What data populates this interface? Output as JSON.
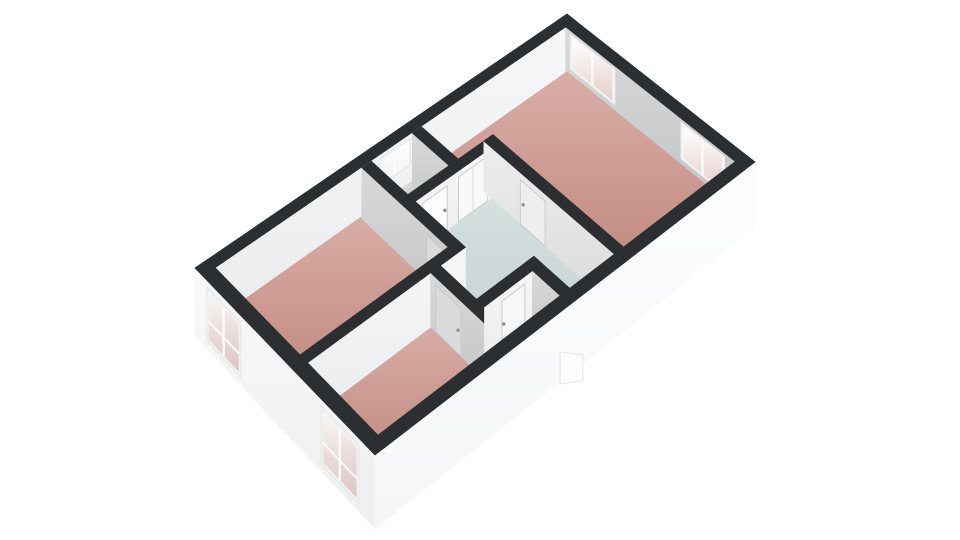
{
  "page": {
    "background": "#ffffff"
  },
  "floorplan": {
    "band_color": "#2c2f31",
    "outline_soft": "#e2e3e4",
    "handle_color": "#8d8f91",
    "door_outline": "#c6c8ca",
    "projection": {
      "corners": {
        "w": [
          195,
          268
        ],
        "n": [
          567,
          14
        ],
        "e": [
          755,
          162
        ],
        "s": [
          375,
          455
        ]
      },
      "plan_size": [
        10,
        6
      ],
      "drop_base": 46,
      "drop_per_y": 0.03,
      "slab_extra": 14
    },
    "gradients": {
      "whiteFace": [
        "#f6f7f8",
        "#eaecee"
      ],
      "grayFace": [
        "#d7d9db",
        "#c2c4c6"
      ],
      "lightFace": [
        "#ebedee",
        "#d9dbdd"
      ],
      "facadeSW": [
        "#f8f9fa",
        "#edeff0"
      ],
      "facadeSE": [
        "#fdfdfe",
        "#f5f6f7"
      ],
      "pinkFloor": [
        "#d8aea6",
        "#bd8279"
      ],
      "toiletFloor": [
        "#d7d9da",
        "#c8cacc"
      ],
      "hallFloor": [
        "#d5e0df",
        "#c3d2d1"
      ],
      "closetFloor": [
        "#e5e7e8",
        "#d8dadb"
      ],
      "glazePink": [
        "#ffffff",
        "#e5cfca"
      ],
      "glazeWhite": [
        "#ffffff",
        "#f1f1f2"
      ],
      "glazeFacade": [
        "#f8f6f6",
        "#ddc4bf"
      ]
    },
    "layers": [
      {
        "t": "top",
        "name": "wall-top-nw",
        "r": [
          0,
          0,
          10,
          0.3
        ]
      },
      {
        "t": "face",
        "name": "wall-nw-interior",
        "a": [
          0.3,
          0.3
        ],
        "b": [
          9.7,
          0.3
        ],
        "g": "whiteFace",
        "feats": [
          {
            "t": "window",
            "name": "window-toilet",
            "a": [
              4.45,
              0.3
            ],
            "b": [
              5.3,
              0.3
            ],
            "f1": 0.08,
            "f2": 0.6,
            "frame": "#f2f3f4",
            "glaze": "glazeWhite",
            "mull": [
              4.88
            ]
          }
        ]
      },
      {
        "t": "top",
        "name": "wall-top-ne",
        "r": [
          9.7,
          0,
          10,
          6
        ]
      },
      {
        "t": "face",
        "name": "wall-ne-interior",
        "a": [
          9.7,
          0.3
        ],
        "b": [
          9.7,
          5.7
        ],
        "g": "grayFace",
        "feats": [
          {
            "t": "window",
            "name": "window-living-1",
            "a": [
              9.7,
              0.45
            ],
            "b": [
              9.7,
              1.95
            ],
            "f1": 0.05,
            "f2": 0.8,
            "frame": "#f4f5f5",
            "glaze": "glazePink",
            "mull": [
              1.2
            ]
          },
          {
            "t": "window",
            "name": "window-living-2",
            "a": [
              9.7,
              4.05
            ],
            "b": [
              9.7,
              5.4
            ],
            "f1": 0.05,
            "f2": 0.8,
            "frame": "#f4f5f5",
            "glaze": "glazePink",
            "mull": [
              4.72
            ]
          }
        ]
      },
      {
        "t": "floor",
        "name": "room-living",
        "pts": [
          [
            5.5,
            0.25
          ],
          [
            9.78,
            0.25
          ],
          [
            9.78,
            5.8
          ],
          [
            6.42,
            5.8
          ],
          [
            6.42,
            1.62
          ],
          [
            5.5,
            1.62
          ]
        ],
        "g": "pinkFloor"
      },
      {
        "t": "floor",
        "name": "room-toilet",
        "pts": [
          [
            4.2,
            0.25
          ],
          [
            5.45,
            0.25
          ],
          [
            5.45,
            1.7
          ],
          [
            4.2,
            1.7
          ]
        ],
        "g": "toiletFloor"
      },
      {
        "t": "floor",
        "name": "room-bedroom-1",
        "pts": [
          [
            0.25,
            0.25
          ],
          [
            4.15,
            0.25
          ],
          [
            4.15,
            3.3
          ],
          [
            0.25,
            3.3
          ]
        ],
        "g": "pinkFloor"
      },
      {
        "t": "floor",
        "name": "room-hall",
        "pts": [
          [
            4.15,
            1.68
          ],
          [
            6.42,
            1.68
          ],
          [
            6.42,
            5.8
          ],
          [
            5.0,
            5.8
          ],
          [
            5.0,
            4.72
          ],
          [
            3.5,
            4.72
          ],
          [
            3.5,
            3.35
          ],
          [
            4.15,
            3.35
          ]
        ],
        "g": "hallFloor"
      },
      {
        "t": "floor",
        "name": "room-bedroom-2",
        "pts": [
          [
            0.25,
            3.35
          ],
          [
            3.5,
            3.35
          ],
          [
            3.5,
            5.8
          ],
          [
            0.25,
            5.8
          ]
        ],
        "g": "pinkFloor"
      },
      {
        "t": "floor",
        "name": "room-closet",
        "pts": [
          [
            3.5,
            4.72
          ],
          [
            4.95,
            4.72
          ],
          [
            4.95,
            5.8
          ],
          [
            3.5,
            5.8
          ]
        ],
        "g": "closetFloor"
      },
      {
        "t": "mat",
        "name": "doormat",
        "r": [
          5.15,
          5.18,
          5.62,
          5.52
        ],
        "fill": "#eaeeed"
      },
      {
        "t": "face",
        "name": "wall-toilet-ne-face",
        "a": [
          5.35,
          0.3
        ],
        "b": [
          5.35,
          1.55
        ],
        "g": "grayFace"
      },
      {
        "t": "face",
        "name": "wall-toilet-ne-cap",
        "a": [
          5.35,
          1.55
        ],
        "b": [
          5.6,
          1.55
        ],
        "g": "whiteFace"
      },
      {
        "t": "top",
        "name": "wall-top-toilet-ne",
        "r": [
          5.35,
          0.3,
          5.6,
          1.55
        ]
      },
      {
        "t": "box",
        "name": "toilet-unit",
        "r": [
          4.3,
          0.95,
          5.0,
          1.5
        ],
        "topf": 0.46,
        "fills": {
          "top": "#cdcfd1",
          "py": "#bdbfc1",
          "mx": "#b0b2b4"
        }
      },
      {
        "t": "face",
        "name": "wall-hall-north-face",
        "a": [
          4.25,
          1.8
        ],
        "b": [
          6.3,
          1.8
        ],
        "g": "whiteFace",
        "feats": [
          {
            "t": "door",
            "name": "door-toilet",
            "a": [
              4.45,
              1.8
            ],
            "b": [
              5.1,
              1.8
            ],
            "f1": 0.14,
            "fill": "#fbfcfc",
            "handle": 0.9
          },
          {
            "t": "cupboard",
            "name": "cupboard-doors",
            "a": [
              5.4,
              1.8
            ],
            "b": [
              6.2,
              1.8
            ],
            "f1": 0.12,
            "fill": "#f8f9fa",
            "mull": [
              5.8
            ]
          }
        ]
      },
      {
        "t": "top",
        "name": "wall-top-hall-north",
        "r": [
          4.25,
          1.55,
          6.55,
          1.8
        ]
      },
      {
        "t": "face",
        "name": "wall-bedroom1-ne-face",
        "a": [
          4.0,
          0.3
        ],
        "b": [
          4.0,
          3.45
        ],
        "g": "grayFace",
        "feats": [
          {
            "t": "door",
            "name": "door-bedroom-1",
            "a": [
              4.0,
              2.5
            ],
            "b": [
              4.0,
              3.3
            ],
            "f1": 0.14,
            "fill": "#d9dbdd",
            "handle": 0.88
          }
        ]
      },
      {
        "t": "face",
        "name": "wall-bedroom1-ne-cap",
        "a": [
          4.0,
          3.45
        ],
        "b": [
          4.25,
          3.45
        ],
        "g": "whiteFace"
      },
      {
        "t": "top",
        "name": "wall-top-bedroom1-ne",
        "r": [
          4.0,
          0.3,
          4.25,
          3.45
        ]
      },
      {
        "t": "face",
        "name": "wall-living-sw-face",
        "a": [
          6.3,
          1.55
        ],
        "b": [
          6.3,
          5.7
        ],
        "g": "lightFace",
        "feats": [
          {
            "t": "door",
            "name": "door-living",
            "a": [
              6.3,
              2.75
            ],
            "b": [
              6.3,
              3.55
            ],
            "f1": 0.14,
            "fill": "#eceeef",
            "handle": 0.12
          }
        ]
      },
      {
        "t": "top",
        "name": "wall-top-living-sw",
        "r": [
          6.3,
          1.55,
          6.55,
          5.7
        ]
      },
      {
        "t": "face",
        "name": "wall-bedroom-divider-face",
        "a": [
          0.3,
          3.45
        ],
        "b": [
          4.25,
          3.45
        ],
        "g": "whiteFace"
      },
      {
        "t": "top",
        "name": "wall-top-bedroom-divider",
        "r": [
          0.3,
          3.2,
          4.25,
          3.45
        ]
      },
      {
        "t": "face",
        "name": "wall-bedroom2-ne-face",
        "a": [
          3.35,
          3.45
        ],
        "b": [
          3.35,
          5.7
        ],
        "g": "grayFace",
        "feats": [
          {
            "t": "door",
            "name": "door-bedroom-2",
            "a": [
              3.35,
              3.62
            ],
            "b": [
              3.35,
              4.42
            ],
            "f1": 0.14,
            "fill": "#d9dbdd",
            "handle": 0.88
          }
        ]
      },
      {
        "t": "top",
        "name": "wall-top-bedroom2-ne",
        "r": [
          3.35,
          3.45,
          3.6,
          5.7
        ]
      },
      {
        "t": "face",
        "name": "wall-closet-nw-face",
        "a": [
          3.6,
          4.85
        ],
        "b": [
          5.1,
          4.85
        ],
        "g": "whiteFace",
        "feats": [
          {
            "t": "door",
            "name": "door-closet",
            "a": [
              4.05,
              4.85
            ],
            "b": [
              4.65,
              4.85
            ],
            "f1": 0.14,
            "fill": "#f6f7f8",
            "handle": 0.08
          }
        ]
      },
      {
        "t": "top",
        "name": "wall-top-closet-nw",
        "r": [
          3.6,
          4.6,
          5.1,
          4.85
        ]
      },
      {
        "t": "face",
        "name": "wall-closet-ne-face",
        "a": [
          4.85,
          4.85
        ],
        "b": [
          4.85,
          5.7
        ],
        "g": "grayFace"
      },
      {
        "t": "top",
        "name": "wall-top-closet-ne",
        "r": [
          4.85,
          4.6,
          5.1,
          5.7
        ]
      },
      {
        "t": "face",
        "name": "facade-sw",
        "a": [
          0,
          0
        ],
        "b": [
          0,
          6
        ],
        "f2": "s",
        "g": "facadeSW",
        "feats": [
          {
            "t": "window",
            "name": "window-bedroom-1",
            "a": [
              0,
              0.42
            ],
            "b": [
              0,
              1.62
            ],
            "f1": 0.12,
            "f2": 1.12,
            "frame": "#eff1f1",
            "glaze": "glazeFacade",
            "mull": [
              1.02
            ],
            "rail": 0.6
          },
          {
            "t": "window",
            "name": "window-bedroom-2",
            "a": [
              0,
              4.3
            ],
            "b": [
              0,
              5.5
            ],
            "f1": 0.12,
            "f2": 1.12,
            "frame": "#eff1f1",
            "glaze": "glazeFacade",
            "mull": [
              4.9
            ],
            "rail": 0.6
          }
        ]
      },
      {
        "t": "top",
        "name": "wall-top-sw",
        "r": [
          0,
          0,
          0.3,
          6
        ]
      },
      {
        "t": "face",
        "name": "facade-se",
        "a": [
          0,
          6
        ],
        "b": [
          10,
          6
        ],
        "f2": "s",
        "g": "facadeSE"
      },
      {
        "t": "top",
        "name": "wall-top-se",
        "r": [
          0,
          5.7,
          10,
          6
        ]
      },
      {
        "t": "bump",
        "name": "front-door-open",
        "a": [
          4.55,
          6.04
        ],
        "b": [
          4.92,
          6.3
        ],
        "h1": 32,
        "h2": 26,
        "fill": "#fcfdfd"
      }
    ]
  }
}
